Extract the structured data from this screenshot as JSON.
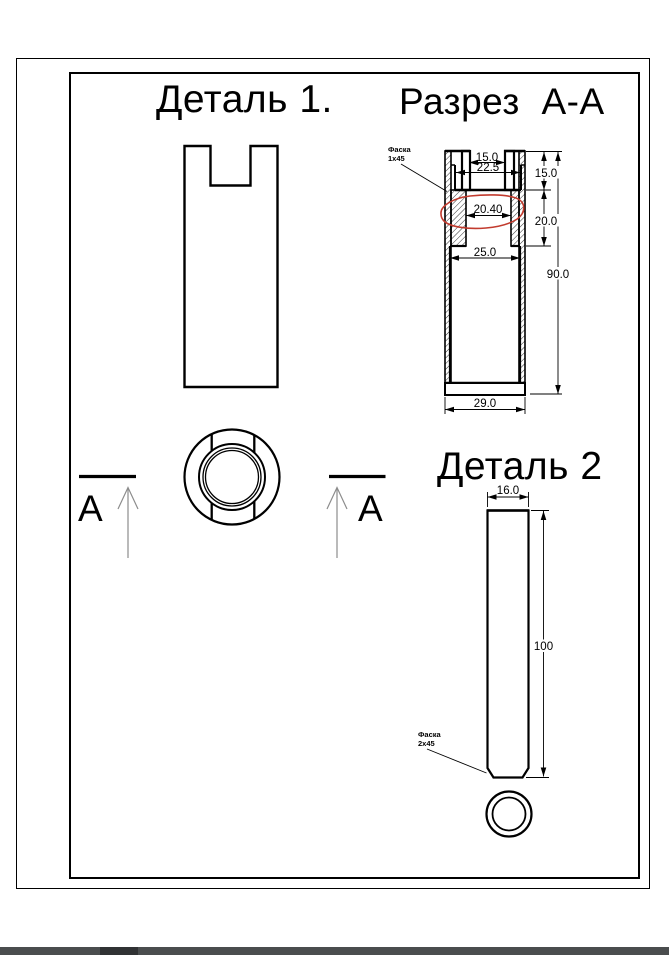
{
  "titles": {
    "detail1": "Деталь 1.",
    "section_aa": "Разрез  А-А",
    "detail2": "Деталь 2"
  },
  "section_marks": {
    "left": "А",
    "right": "А"
  },
  "section_aa": {
    "dims": {
      "top_slot_width": "15.0",
      "recess_width": "22.5",
      "bore_circled": "20.40",
      "lower_bore_width": "25.0",
      "outer_bottom_width": "29.0",
      "top_height": "15.0",
      "mid_height": "20.0",
      "total_height": "90.0"
    },
    "chamfer_note": {
      "line1": "Фаска",
      "line2": "1x45"
    }
  },
  "detail2": {
    "dims": {
      "width": "16.0",
      "length": "100"
    },
    "chamfer_note": {
      "line1": "Фаска",
      "line2": "2x45"
    }
  },
  "colors": {
    "line": "#000000",
    "annotation_red": "#c23b2e",
    "section_arrow_gray": "#8c8c8c",
    "taskbar": "#4a4d4e"
  }
}
